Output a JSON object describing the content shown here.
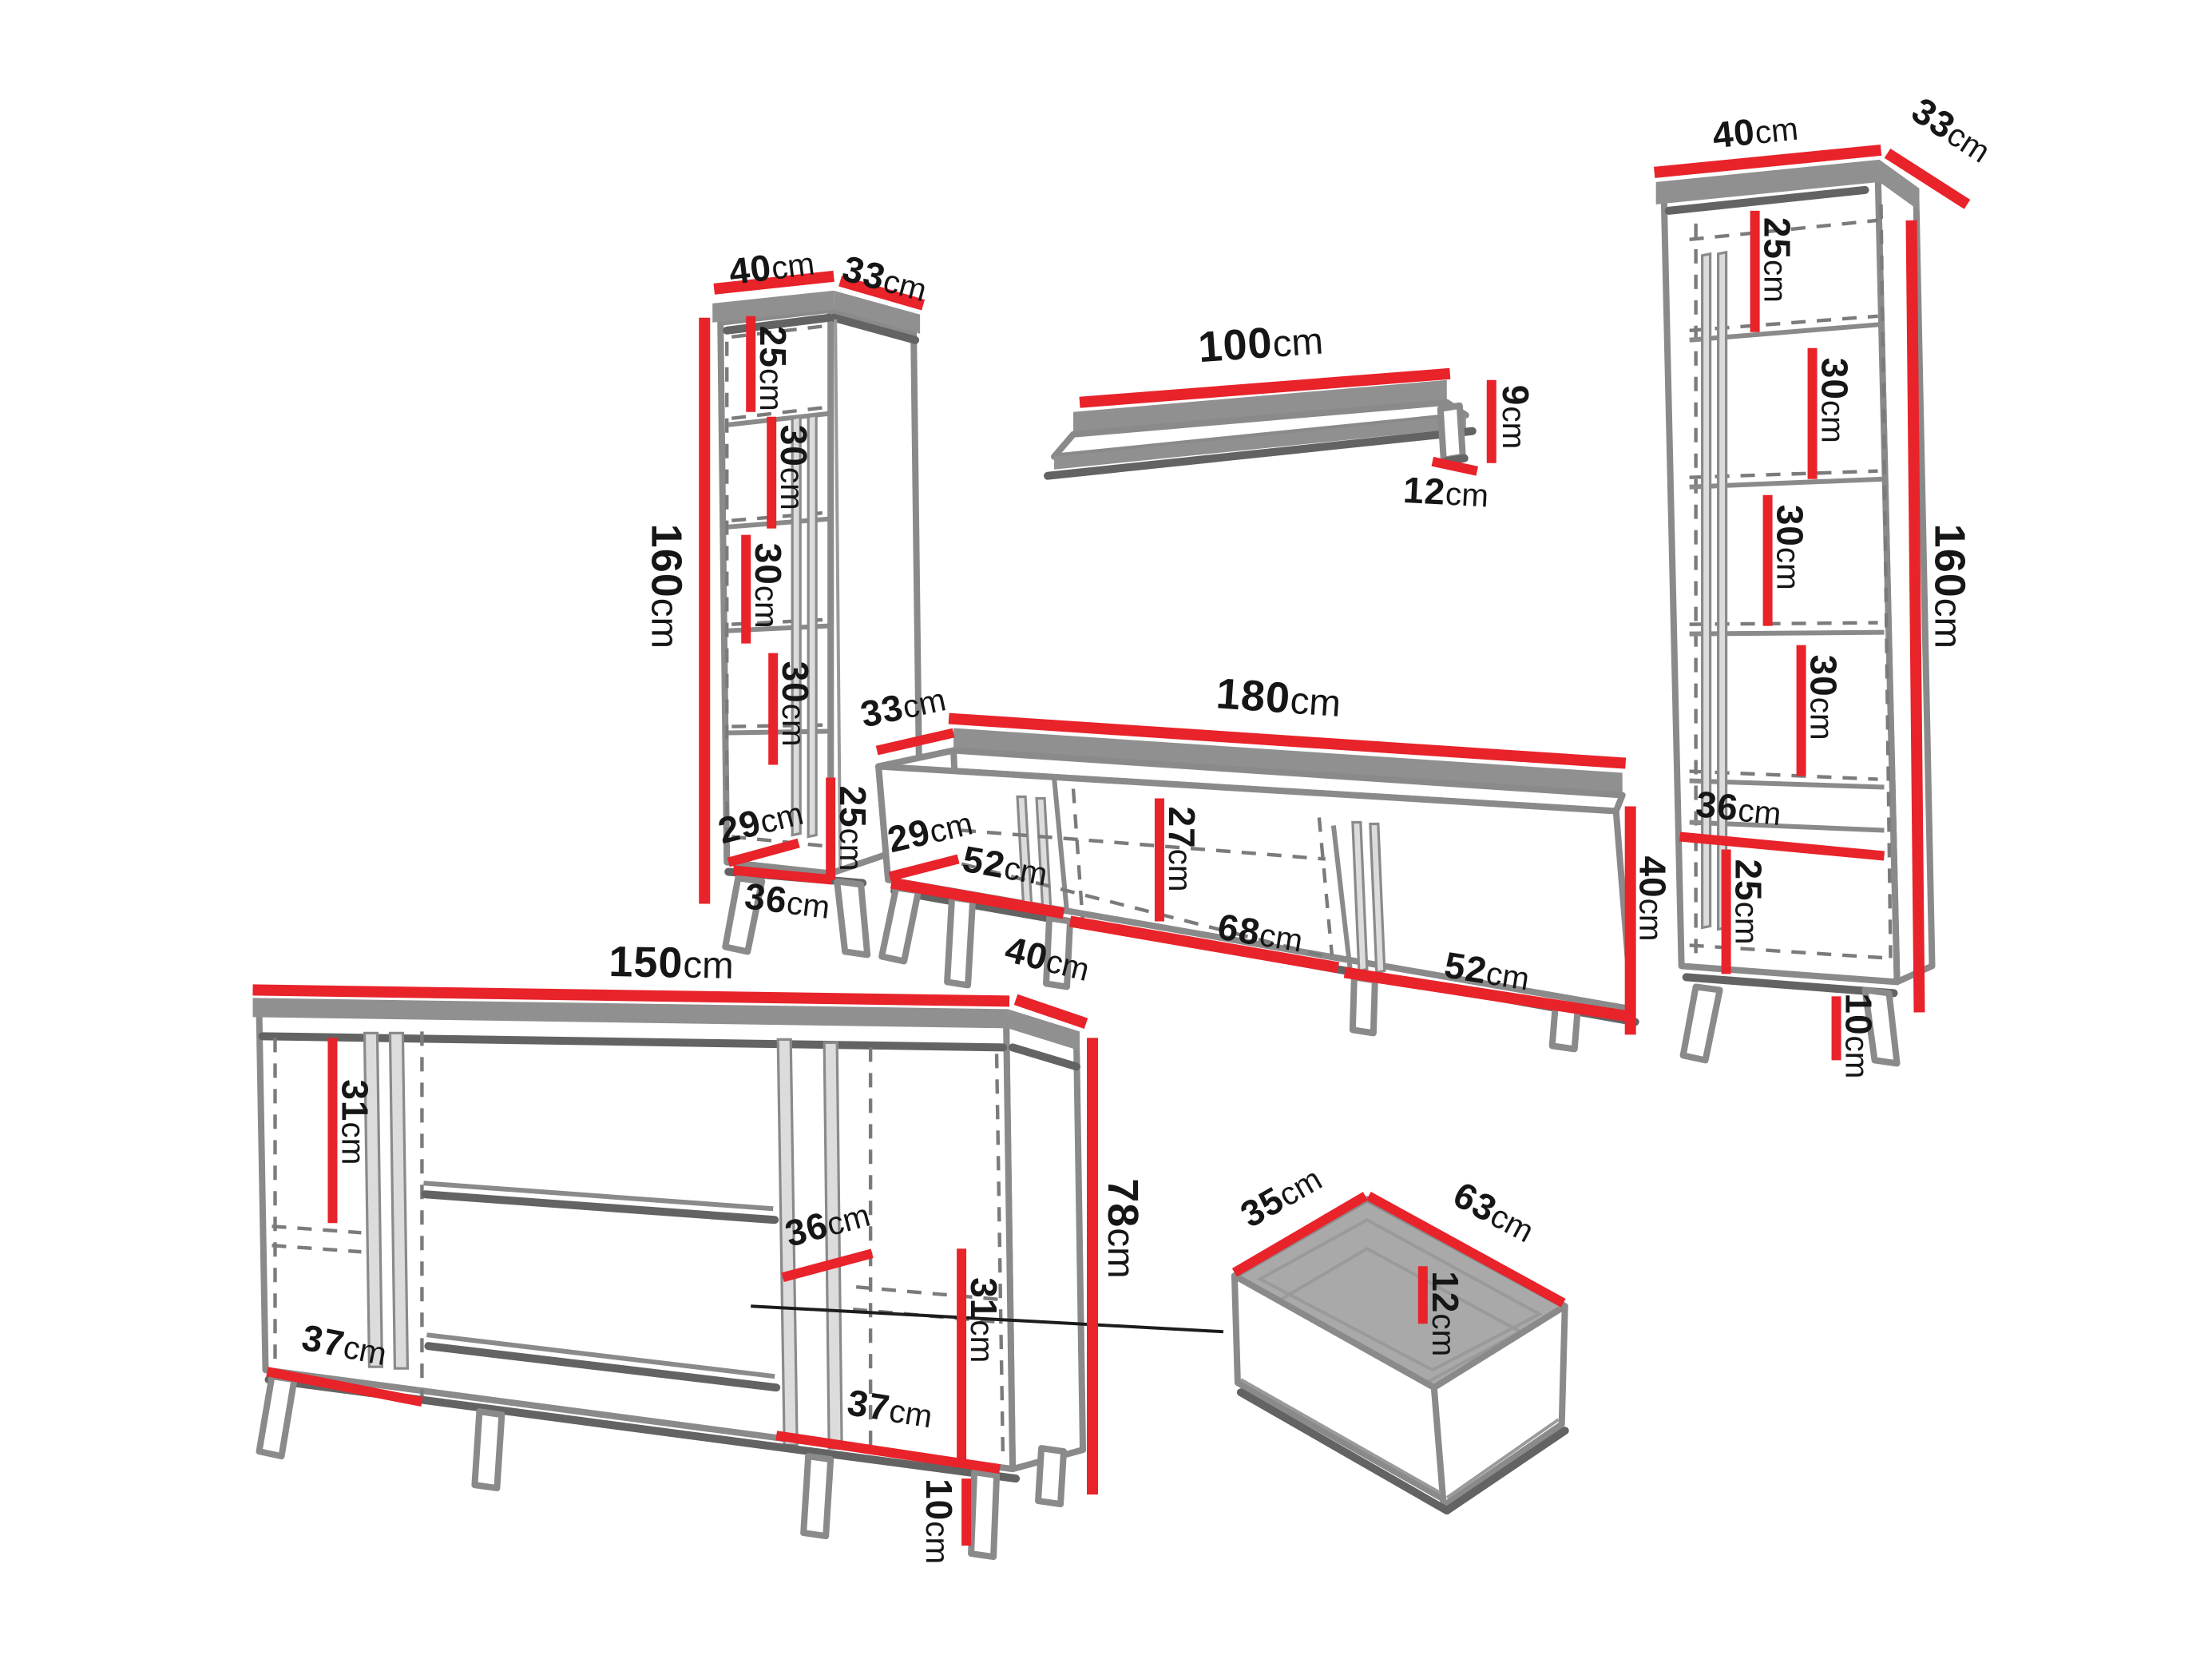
{
  "diagram": {
    "description": "Wall unit furniture dimension diagram",
    "background": "#ffffff",
    "colors": {
      "dimension_line": "#e8232a",
      "outline": "#8a8a8a",
      "shadow": "#636363",
      "text": "#161616"
    },
    "pieces": {
      "left_cabinet": {
        "label": "tall cabinet left",
        "dims": {
          "top_width": {
            "value": "40",
            "unit": "cm"
          },
          "top_depth": {
            "value": "33",
            "unit": "cm"
          },
          "height": {
            "value": "160",
            "unit": "cm"
          },
          "section_1": {
            "value": "25",
            "unit": "cm"
          },
          "section_2": {
            "value": "30",
            "unit": "cm"
          },
          "section_3": {
            "value": "30",
            "unit": "cm"
          },
          "section_4": {
            "value": "30",
            "unit": "cm"
          },
          "bottom_section": {
            "value": "25",
            "unit": "cm"
          },
          "inner_depth": {
            "value": "29",
            "unit": "cm"
          },
          "inner_width": {
            "value": "36",
            "unit": "cm"
          }
        }
      },
      "wall_shelf": {
        "label": "wall shelf",
        "dims": {
          "width": {
            "value": "100",
            "unit": "cm"
          },
          "height": {
            "value": "9",
            "unit": "cm"
          },
          "depth": {
            "value": "12",
            "unit": "cm"
          }
        }
      },
      "right_cabinet": {
        "label": "tall cabinet right",
        "dims": {
          "top_width": {
            "value": "40",
            "unit": "cm"
          },
          "top_depth": {
            "value": "33",
            "unit": "cm"
          },
          "height": {
            "value": "160",
            "unit": "cm"
          },
          "section_1": {
            "value": "25",
            "unit": "cm"
          },
          "section_2": {
            "value": "30",
            "unit": "cm"
          },
          "section_3": {
            "value": "30",
            "unit": "cm"
          },
          "section_4": {
            "value": "30",
            "unit": "cm"
          },
          "shelf_width": {
            "value": "36",
            "unit": "cm"
          },
          "bottom_section": {
            "value": "25",
            "unit": "cm"
          },
          "leg_height": {
            "value": "10",
            "unit": "cm"
          }
        }
      },
      "tv_stand": {
        "label": "TV stand",
        "dims": {
          "top_depth": {
            "value": "33",
            "unit": "cm"
          },
          "top_width": {
            "value": "180",
            "unit": "cm"
          },
          "inner_depth": {
            "value": "29",
            "unit": "cm"
          },
          "door_left_width": {
            "value": "52",
            "unit": "cm"
          },
          "middle_width": {
            "value": "68",
            "unit": "cm"
          },
          "door_right_width": {
            "value": "52",
            "unit": "cm"
          },
          "inner_height": {
            "value": "27",
            "unit": "cm"
          },
          "height": {
            "value": "40",
            "unit": "cm"
          }
        }
      },
      "sideboard": {
        "label": "sideboard",
        "dims": {
          "top_width": {
            "value": "150",
            "unit": "cm"
          },
          "top_depth": {
            "value": "40",
            "unit": "cm"
          },
          "left_inner_height": {
            "value": "31",
            "unit": "cm"
          },
          "shelf_depth": {
            "value": "36",
            "unit": "cm"
          },
          "right_inner_height": {
            "value": "31",
            "unit": "cm"
          },
          "left_inner_width": {
            "value": "37",
            "unit": "cm"
          },
          "right_inner_width": {
            "value": "37",
            "unit": "cm"
          },
          "height": {
            "value": "78",
            "unit": "cm"
          },
          "leg_height": {
            "value": "10",
            "unit": "cm"
          }
        }
      },
      "drawer": {
        "label": "drawer detail",
        "dims": {
          "depth": {
            "value": "35",
            "unit": "cm"
          },
          "width": {
            "value": "63",
            "unit": "cm"
          },
          "height": {
            "value": "12",
            "unit": "cm"
          }
        }
      }
    }
  }
}
